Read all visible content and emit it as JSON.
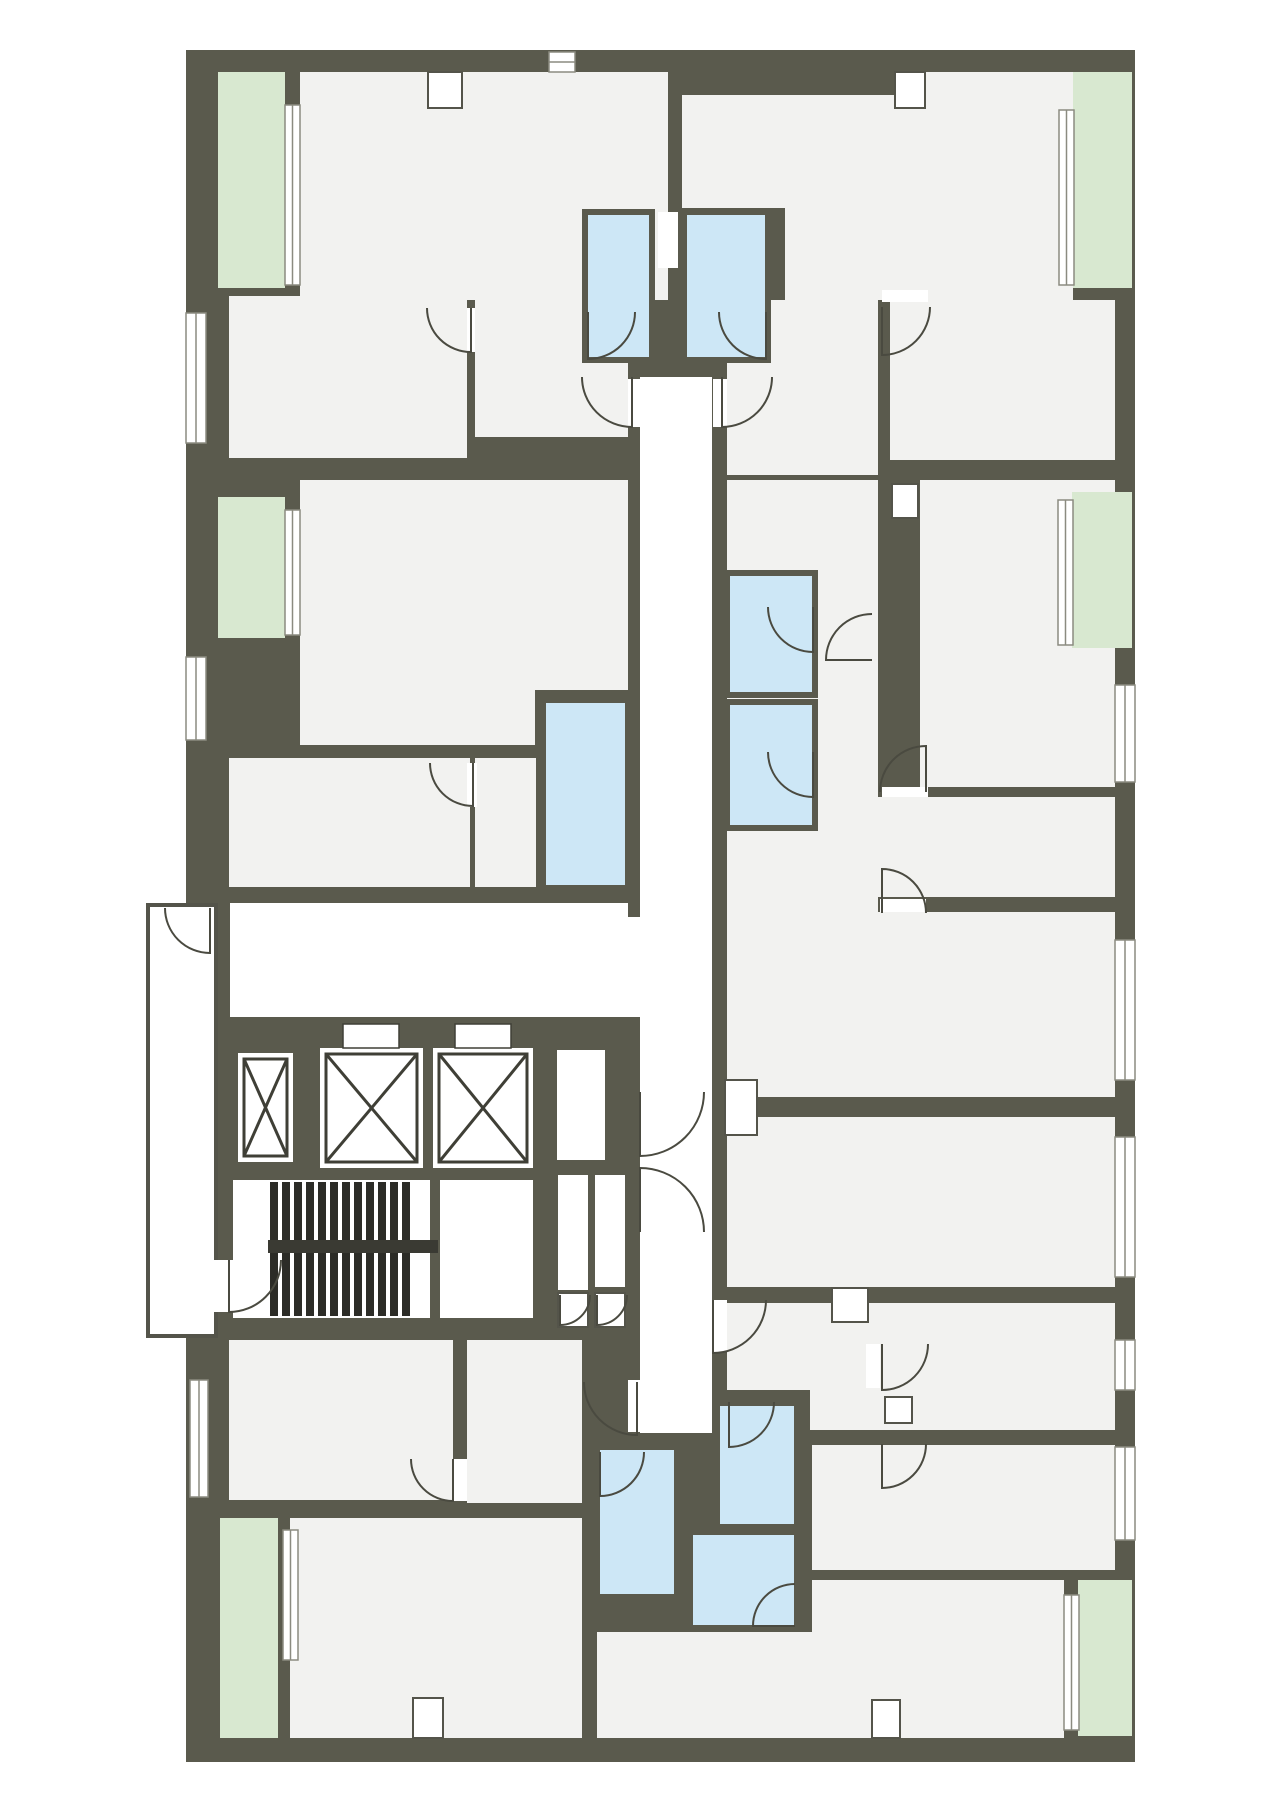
{
  "canvas": {
    "width": 1280,
    "height": 1810
  },
  "palette": {
    "wall": "#5a5a4d",
    "room": "#f2f2f0",
    "corridor": "#ffffff",
    "bath": "#cde7f6",
    "balcony": "#d8e8d0",
    "tread": "#2c2c27",
    "rail": "#3a3a33",
    "door_stroke": "#4a4a40",
    "window_stroke": "#8b8b80",
    "shaft_stroke": "#3f3f36",
    "gallery_stroke": "#54544a",
    "bath_wall": "#5a5a4d"
  },
  "slab": {
    "x": 186,
    "y": 50,
    "w": 949,
    "h": 1712
  },
  "gallery": {
    "x": 148,
    "y": 905,
    "w": 68,
    "h": 431
  },
  "rooms": [
    [
      300,
      72,
      368,
      228
    ],
    [
      682,
      72,
      391,
      136
    ],
    [
      785,
      208,
      288,
      92
    ],
    [
      229,
      296,
      238,
      162
    ],
    [
      475,
      296,
      153,
      141
    ],
    [
      300,
      480,
      328,
      210
    ],
    [
      300,
      690,
      235,
      55
    ],
    [
      229,
      758,
      241,
      129
    ],
    [
      475,
      758,
      61,
      129
    ],
    [
      727,
      300,
      151,
      175
    ],
    [
      890,
      300,
      225,
      160
    ],
    [
      727,
      480,
      151,
      432
    ],
    [
      920,
      480,
      195,
      307
    ],
    [
      878,
      797,
      237,
      100
    ],
    [
      727,
      912,
      388,
      185
    ],
    [
      727,
      1117,
      388,
      170
    ],
    [
      727,
      1303,
      388,
      87
    ],
    [
      810,
      1390,
      305,
      40
    ],
    [
      812,
      1445,
      303,
      125
    ],
    [
      812,
      1580,
      252,
      158
    ],
    [
      229,
      1340,
      224,
      160
    ],
    [
      467,
      1340,
      115,
      163
    ],
    [
      290,
      1518,
      292,
      220
    ],
    [
      597,
      1632,
      215,
      106
    ]
  ],
  "corridors": [
    [
      640,
      377,
      72,
      1056
    ],
    [
      230,
      903,
      398,
      114
    ],
    [
      628,
      917,
      12,
      100
    ],
    [
      233,
      1180,
      197,
      138
    ],
    [
      440,
      1180,
      93,
      138
    ],
    [
      557,
      1050,
      48,
      110
    ],
    [
      558,
      1175,
      30,
      115
    ],
    [
      595,
      1175,
      30,
      112
    ],
    [
      658,
      212,
      20,
      56
    ]
  ],
  "balconies": [
    [
      218,
      72,
      67,
      216
    ],
    [
      218,
      497,
      67,
      141
    ],
    [
      1073,
      72,
      59,
      216
    ],
    [
      1072,
      492,
      60,
      156
    ],
    [
      220,
      1518,
      58,
      220
    ],
    [
      1078,
      1580,
      54,
      156
    ]
  ],
  "baths": [
    [
      585,
      212,
      67,
      148
    ],
    [
      684,
      212,
      84,
      148
    ],
    [
      543,
      700,
      85,
      188
    ],
    [
      727,
      573,
      88,
      122
    ],
    [
      727,
      702,
      88,
      126
    ],
    [
      717,
      1403,
      80,
      124
    ],
    [
      690,
      1532,
      107,
      96
    ],
    [
      597,
      1447,
      80,
      150
    ]
  ],
  "wall_overlays": [
    [
      682,
      50,
      218,
      45
    ]
  ],
  "notches": [
    [
      428,
      72,
      34,
      36
    ],
    [
      895,
      72,
      30,
      36
    ],
    [
      892,
      484,
      26,
      34
    ],
    [
      725,
      1080,
      32,
      55
    ],
    [
      832,
      1288,
      36,
      34
    ],
    [
      413,
      1698,
      30,
      40
    ],
    [
      872,
      1700,
      28,
      38
    ],
    [
      885,
      1397,
      27,
      26
    ],
    [
      558,
      1293,
      30,
      34
    ],
    [
      595,
      1293,
      30,
      34
    ]
  ],
  "door_gaps": [
    [
      628,
      1380,
      12,
      52
    ],
    [
      713,
      1300,
      14,
      52
    ],
    [
      866,
      1344,
      14,
      44
    ],
    [
      628,
      379,
      12,
      48
    ],
    [
      713,
      379,
      14,
      48
    ],
    [
      212,
      1260,
      21,
      52
    ],
    [
      453,
      1459,
      14,
      42
    ],
    [
      467,
      763,
      10,
      44
    ],
    [
      880,
      899,
      46,
      13
    ],
    [
      882,
      787,
      46,
      10
    ],
    [
      882,
      290,
      46,
      12
    ],
    [
      467,
      308,
      8,
      44
    ]
  ],
  "windows": [
    [
      186,
      313,
      20,
      130
    ],
    [
      186,
      657,
      20,
      83
    ],
    [
      190,
      1380,
      18,
      117
    ],
    [
      285,
      105,
      15,
      180
    ],
    [
      285,
      510,
      15,
      125
    ],
    [
      283,
      1530,
      15,
      130
    ],
    [
      1059,
      110,
      15,
      175
    ],
    [
      1058,
      500,
      15,
      145
    ],
    [
      1064,
      1595,
      15,
      135
    ],
    [
      1115,
      685,
      20,
      97
    ],
    [
      1115,
      940,
      20,
      140
    ],
    [
      1115,
      1137,
      20,
      140
    ],
    [
      1115,
      1340,
      20,
      50
    ],
    [
      1115,
      1447,
      20,
      93
    ],
    [
      549,
      52,
      26,
      20
    ]
  ],
  "elevators": {
    "shafts": [
      [
        238,
        1053,
        55,
        109
      ],
      [
        320,
        1048,
        103,
        120
      ],
      [
        433,
        1048,
        100,
        120
      ]
    ],
    "door_slots": [
      [
        343,
        1024,
        56,
        24
      ],
      [
        455,
        1024,
        56,
        24
      ]
    ]
  },
  "stairs": {
    "treads": {
      "x0": 270,
      "y": 1182,
      "count": 12,
      "step": 12,
      "w": 8,
      "h": 134
    },
    "rail": [
      268,
      1240,
      170,
      13
    ]
  },
  "doors": [
    {
      "c": [
        588,
        312
      ],
      "r": 47,
      "a1": 90,
      "a2": 0
    },
    {
      "c": [
        766,
        312
      ],
      "r": 47,
      "a1": 90,
      "a2": 180
    },
    {
      "c": [
        632,
        377
      ],
      "r": 50,
      "a1": 90,
      "a2": 180
    },
    {
      "c": [
        722,
        377
      ],
      "r": 50,
      "a1": 90,
      "a2": 0
    },
    {
      "c": [
        471,
        308
      ],
      "r": 44,
      "a1": 90,
      "a2": 180
    },
    {
      "c": [
        882,
        307
      ],
      "r": 48,
      "a1": 90,
      "a2": 0
    },
    {
      "c": [
        872,
        660
      ],
      "r": 46,
      "a1": 180,
      "a2": 270
    },
    {
      "c": [
        813,
        607
      ],
      "r": 45,
      "a1": 90,
      "a2": 180
    },
    {
      "c": [
        813,
        752
      ],
      "r": 45,
      "a1": 90,
      "a2": 180
    },
    {
      "c": [
        473,
        763
      ],
      "r": 43,
      "a1": 90,
      "a2": 180
    },
    {
      "c": [
        210,
        908
      ],
      "r": 45,
      "a1": 90,
      "a2": 180
    },
    {
      "c": [
        229,
        1260
      ],
      "r": 52,
      "a1": 90,
      "a2": 0
    },
    {
      "c": [
        640,
        1092
      ],
      "r": 64,
      "a1": 90,
      "a2": 0
    },
    {
      "c": [
        640,
        1232
      ],
      "r": 64,
      "a1": 270,
      "a2": 0
    },
    {
      "c": [
        637,
        1382
      ],
      "r": 53,
      "a1": 90,
      "a2": 180
    },
    {
      "c": [
        713,
        1300
      ],
      "r": 53,
      "a1": 90,
      "a2": 0
    },
    {
      "c": [
        882,
        1344
      ],
      "r": 46,
      "a1": 90,
      "a2": 0
    },
    {
      "c": [
        882,
        1444
      ],
      "r": 44,
      "a1": 90,
      "a2": 0
    },
    {
      "c": [
        600,
        1452
      ],
      "r": 44,
      "a1": 90,
      "a2": 0
    },
    {
      "c": [
        795,
        1626
      ],
      "r": 42,
      "a1": 180,
      "a2": 270
    },
    {
      "c": [
        729,
        1402
      ],
      "r": 45,
      "a1": 90,
      "a2": 0
    },
    {
      "c": [
        453,
        1459
      ],
      "r": 42,
      "a1": 90,
      "a2": 180
    },
    {
      "c": [
        882,
        913
      ],
      "r": 44,
      "a1": 270,
      "a2": 0
    },
    {
      "c": [
        926,
        792
      ],
      "r": 46,
      "a1": 270,
      "a2": 180
    },
    {
      "c": [
        560,
        1295
      ],
      "r": 30,
      "a1": 90,
      "a2": 0
    },
    {
      "c": [
        597,
        1295
      ],
      "r": 30,
      "a1": 90,
      "a2": 0
    }
  ]
}
